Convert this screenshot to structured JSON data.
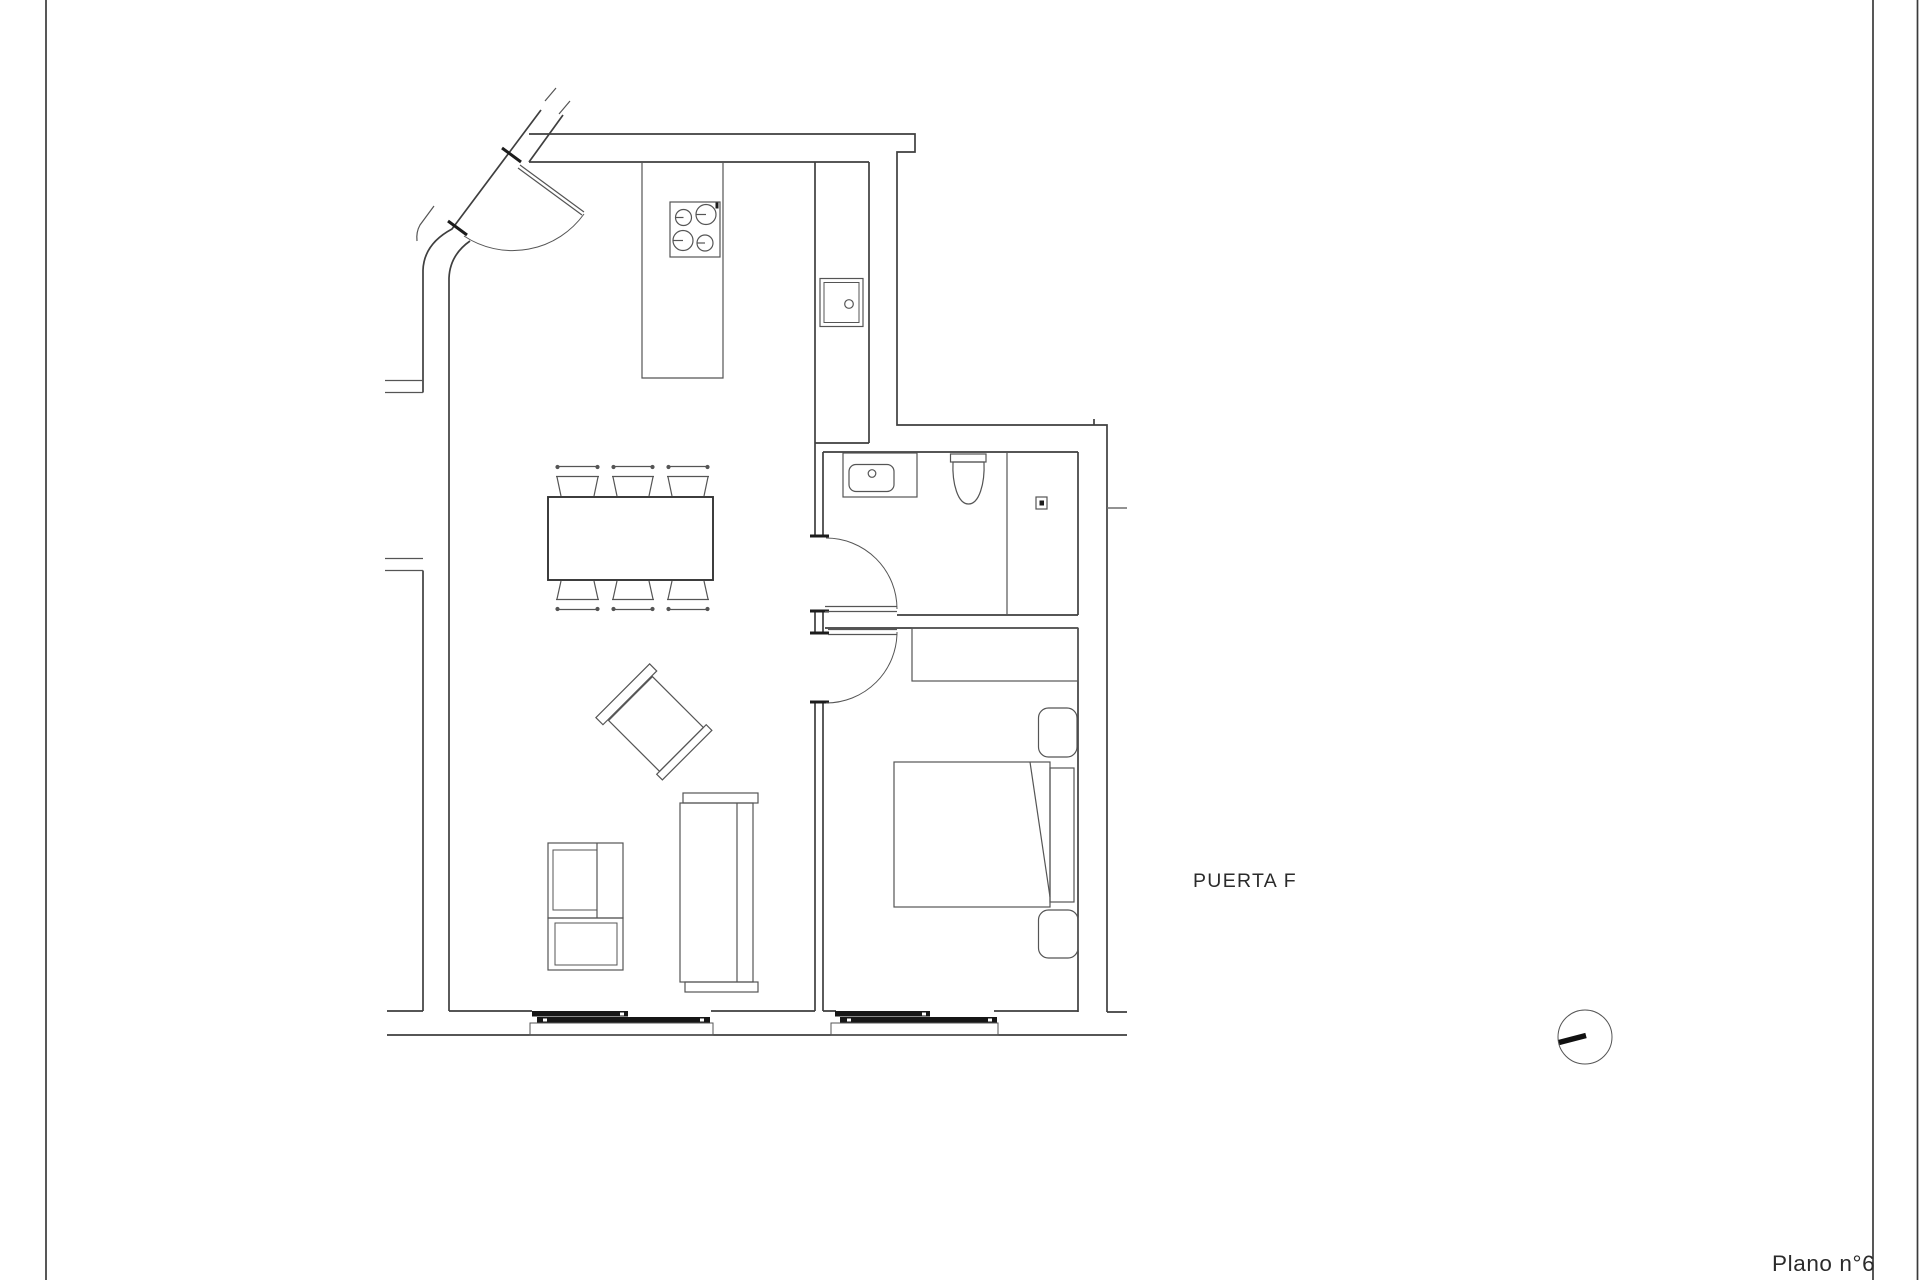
{
  "sheet": {
    "labels": {
      "door": "PUERTA F",
      "plan_number": "Plano n°6"
    },
    "colors": {
      "background": "#ffffff",
      "frame": "#3a3a3a",
      "wall": "#3f3f3f",
      "furniture": "#555555",
      "window": "#161616",
      "text": "#2b2b2b"
    }
  }
}
